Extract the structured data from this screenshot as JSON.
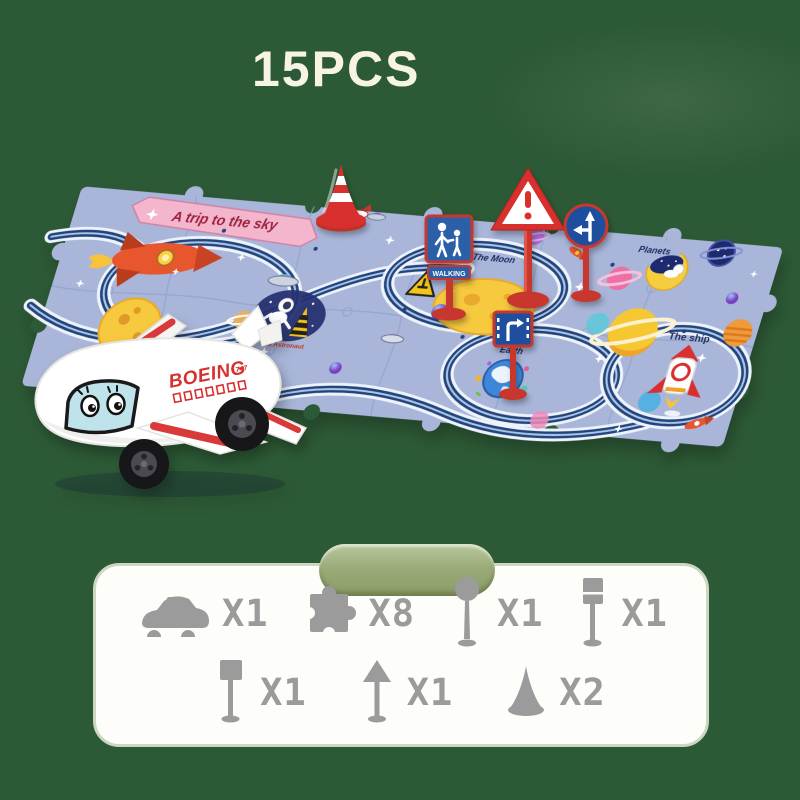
{
  "page": {
    "title": "15PCS",
    "background_color": "#2d5a36"
  },
  "mat": {
    "banner": "A trip to the sky",
    "labels": {
      "the_moon": "The Moon",
      "planets": "Planets",
      "earth": "Earth",
      "the_ship": "The ship",
      "astronaut": "The Astronaut"
    },
    "signs": {
      "walking": "WALKING"
    },
    "colors": {
      "mat": "#A9B6DA",
      "track": "#24427C",
      "sign_red": "#C8372D",
      "sign_blue": "#2B5FA8",
      "pill": "#9AAA7B"
    }
  },
  "plane": {
    "brand": "BOEING",
    "model": "747"
  },
  "parts_panel": {
    "items": [
      {
        "name": "toy-vehicle",
        "icon": "car-icon",
        "qty": "X1"
      },
      {
        "name": "puzzle-track-piece",
        "icon": "puzzle-piece-icon",
        "qty": "X8"
      },
      {
        "name": "round-sign",
        "icon": "round-sign-icon",
        "qty": "X1"
      },
      {
        "name": "tall-rect-sign",
        "icon": "rect-sign-icon",
        "qty": "X1"
      },
      {
        "name": "square-sign",
        "icon": "square-sign-icon",
        "qty": "X1"
      },
      {
        "name": "triangle-sign",
        "icon": "triangle-sign-icon",
        "qty": "X1"
      },
      {
        "name": "traffic-cone",
        "icon": "cone-icon",
        "qty": "X2"
      }
    ]
  }
}
